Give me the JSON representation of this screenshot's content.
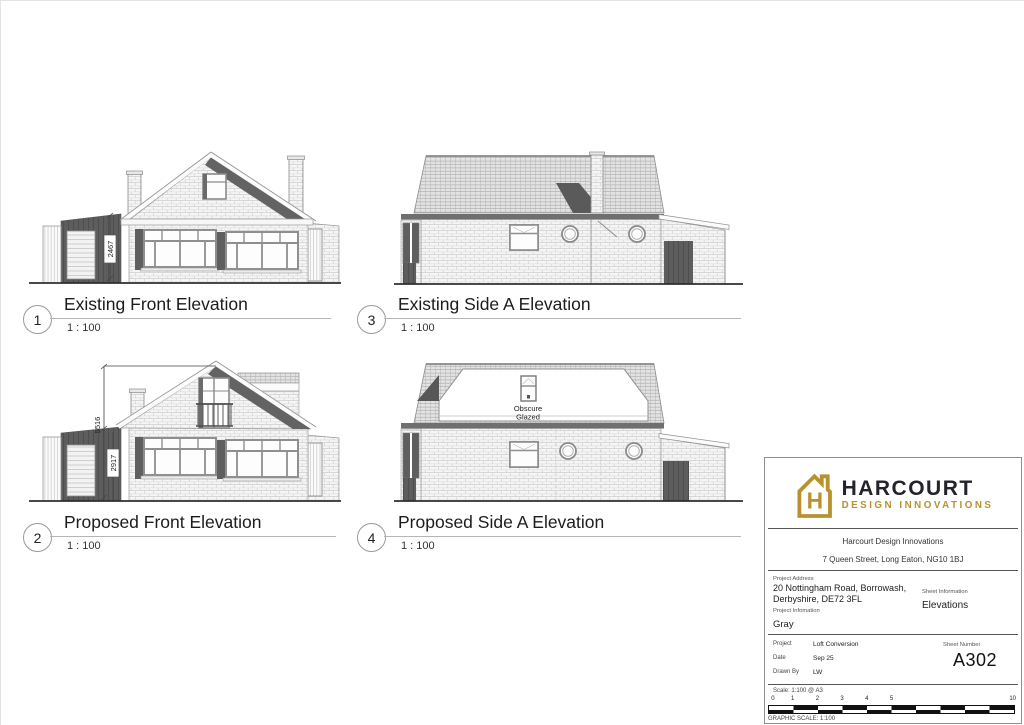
{
  "views": {
    "v1": {
      "number": "1",
      "title": "Existing Front Elevation",
      "scale": "1 : 100"
    },
    "v3": {
      "number": "3",
      "title": "Existing Side A Elevation",
      "scale": "1 : 100"
    },
    "v2": {
      "number": "2",
      "title": "Proposed Front Elevation",
      "scale": "1 : 100"
    },
    "v4": {
      "number": "4",
      "title": "Proposed Side A Elevation",
      "scale": "1 : 100"
    }
  },
  "annotations": {
    "existing_garage_height": "2467",
    "proposed_ridge_height": "5516",
    "proposed_garage_height": "2917",
    "obscure_line1": "Obscure",
    "obscure_line2": "Glazed"
  },
  "titleblock": {
    "brand_name": "HARCOURT",
    "brand_tagline": "DESIGN INNOVATIONS",
    "company": "Harcourt Design Innovations",
    "company_address": "7 Queen Street, Long Eaton, NG10 1BJ",
    "project_address_label": "Project Address",
    "project_address_line1": "20 Nottingham Road, Borrowash,",
    "project_address_line2": "Derbyshire, DE72 3FL",
    "project_information_label": "Project Infomation",
    "project_information": "Gray",
    "sheet_information_label": "Sheet Information",
    "sheet_information": "Elevations",
    "project_label": "Project",
    "project": "Loft Conversion",
    "date_label": "Date",
    "date": "Sep 25",
    "drawn_by_label": "Drawn By",
    "drawn_by": "LW",
    "sheet_number_label": "Sheet Number",
    "sheet_number": "A302",
    "scale_note": "Scale: 1:100 @ A3",
    "graphic_scale_label": "GRAPHIC SCALE: 1:100",
    "scale_ticks": [
      "0",
      "1",
      "2",
      "3",
      "4",
      "5",
      "10"
    ]
  },
  "colors": {
    "accent_gold": "#B8922F",
    "wordmark_dark": "#23232B"
  }
}
